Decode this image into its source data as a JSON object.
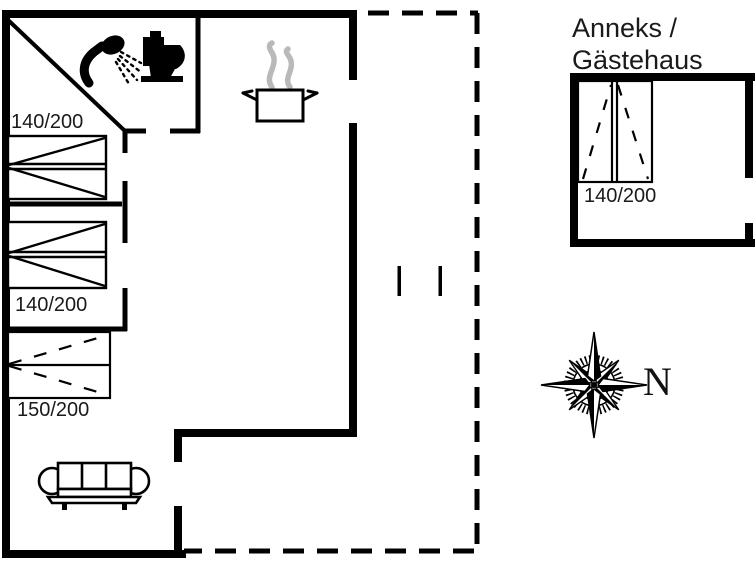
{
  "plan": {
    "main_house": {
      "bed1_label": "140/200",
      "bed2_label": "140/200",
      "bed3_label": "150/200"
    },
    "annex": {
      "title_line1": "Anneks /",
      "title_line2": "Gästehaus",
      "bed_label": "140/200"
    },
    "compass": {
      "north_label": "N"
    },
    "icons": {
      "shower": "shower-icon",
      "toilet": "toilet-icon",
      "cooking_pot": "cooking-pot-icon",
      "steam": "steam-icon",
      "sofa": "sofa-icon",
      "compass_rose": "compass-rose-icon"
    },
    "colors": {
      "wall": "#000000",
      "background": "#ffffff",
      "steam": "#b9b9b9",
      "text": "#1a1a1a"
    }
  }
}
